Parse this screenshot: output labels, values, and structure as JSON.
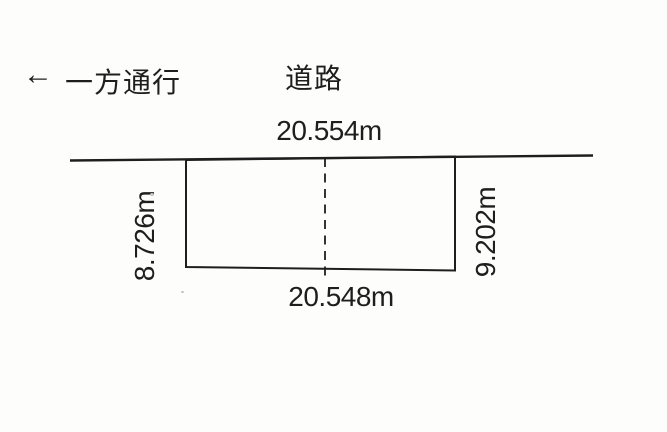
{
  "canvas": {
    "background": "#fdfdfc",
    "ink": "#1e1e1e"
  },
  "header": {
    "one_way_arrow": "←",
    "one_way_label": "一方通行",
    "road_label": "道路"
  },
  "lot": {
    "top_dimension": "20.554m",
    "bottom_dimension": "20.548m",
    "left_dimension": "8.726m",
    "right_dimension": "9.202m"
  }
}
